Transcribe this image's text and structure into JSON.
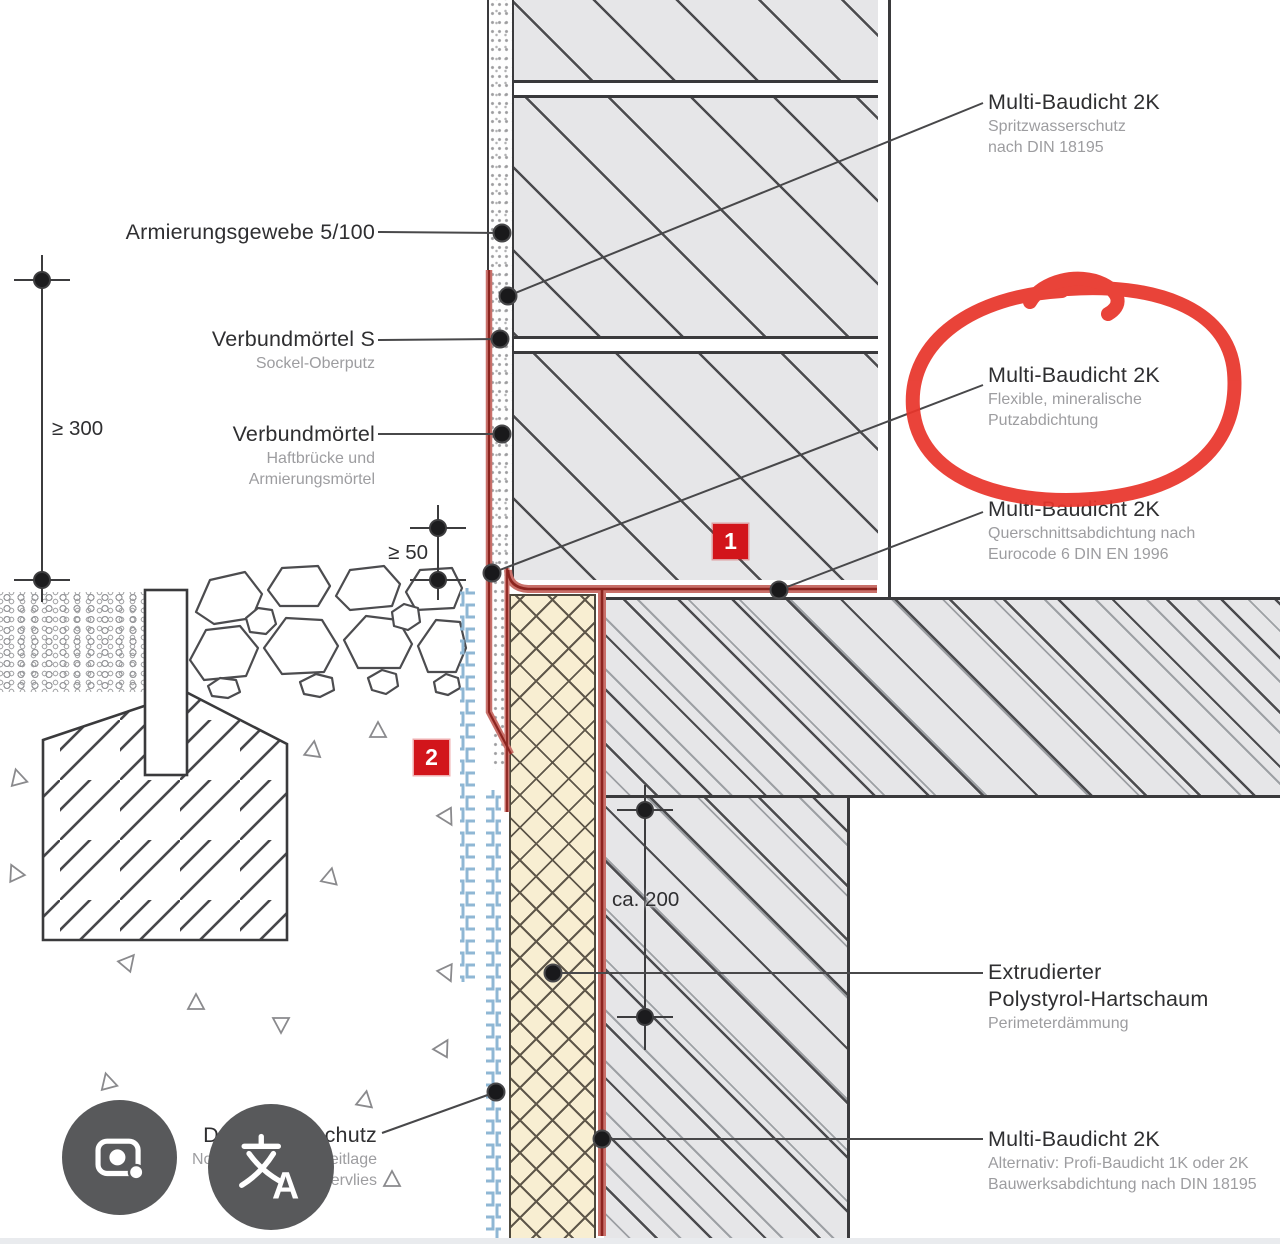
{
  "labels": {
    "spritz": {
      "title": "Multi-Baudicht 2K",
      "sub1": "Spritzwasserschutz",
      "sub2": "nach DIN 18195"
    },
    "armierung": {
      "title": "Armierungsgewebe 5/100"
    },
    "verbund_s": {
      "title": "Verbundmörtel S",
      "sub1": "Sockel-Oberputz"
    },
    "verbund": {
      "title": "Verbundmörtel",
      "sub1": "Haftbrücke und",
      "sub2": "Armierungsmörtel"
    },
    "putz": {
      "title": "Multi-Baudicht 2K",
      "sub1": "Flexible, mineralische",
      "sub2": "Putzabdichtung"
    },
    "quer": {
      "title": "Multi-Baudicht 2K",
      "sub1": "Querschnittsabdichtung nach",
      "sub2": "Eurocode 6 DIN EN 1996"
    },
    "xps": {
      "title1": "Extrudierter",
      "title2": "Polystyrol-Hartschaum",
      "sub1": "Perimeterdämmung"
    },
    "bauwerk": {
      "title": "Multi-Baudicht 2K",
      "sub1": "Alternativ: Profi-Baudicht 1K oder 2K",
      "sub2": "Bauwerksabdichtung nach DIN 18195"
    },
    "ds": {
      "title": "DS-Systemschutz",
      "sub1": "Noppenbahn mit Gleitlage",
      "sub2": "und Filtervlies"
    }
  },
  "dimensions": {
    "d300": "≥ 300",
    "d50": "≥ 50",
    "d200": "ca. 200"
  },
  "markers": {
    "m1": "1",
    "m2": "2"
  },
  "icons": {
    "camera": "camera-lens-icon",
    "translate": "translate-icon"
  },
  "colors": {
    "annotation_red": "#e8352b",
    "marker_red": "#d2151b",
    "membrane_core_red": "#8c241f",
    "membrane_band_red": "#c9706a",
    "insulation_cream": "#f8eed2",
    "dimple_blue": "#8fb7d4",
    "concrete_gray": "#e6e6e8",
    "icon_circle_gray": "#58595b"
  }
}
